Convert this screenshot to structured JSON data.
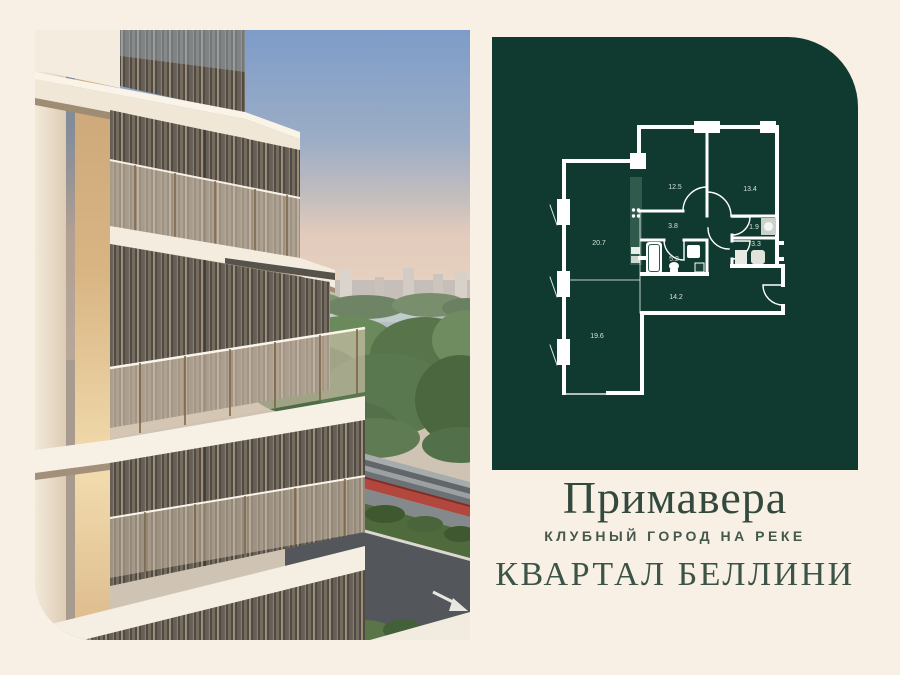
{
  "colors": {
    "background": "#f8efe5",
    "panel_green": "#103a2f",
    "text_green": "#33493d",
    "plan_walls": "#ffffff",
    "road_red_stripe": "#b2473d"
  },
  "photo": {
    "description": "building-exterior-render"
  },
  "plan": {
    "areas": {
      "left_top": "20.7",
      "left_bottom": "19.6",
      "mid_top": "12.5",
      "right_top": "13.4",
      "hall": "3.8",
      "laundry": "1.9",
      "wc": "3.3",
      "bath": "5.2",
      "corridor": "14.2"
    }
  },
  "brand": {
    "title": "Примавера",
    "subtitle": "КЛУБНЫЙ ГОРОД НА РЕКЕ",
    "district": "КВАРТАЛ БЕЛЛИНИ"
  }
}
